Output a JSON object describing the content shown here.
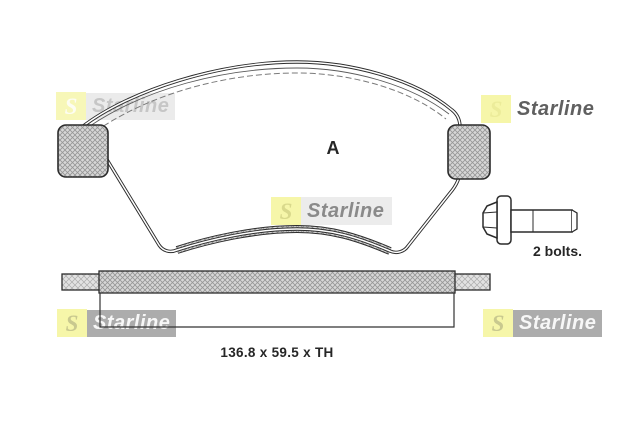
{
  "page": {
    "background": "#ffffff",
    "content_type": "brake-pad-set-technical-illustration"
  },
  "brand": {
    "name": "Starline",
    "initial": "S",
    "accent_yellow": "#f6f6a9",
    "logo_gray": "#acacac"
  },
  "drawing": {
    "view_label": "A",
    "bolt_caption": "2 bolts.",
    "dimension_caption": "136.8 x 59.5 x TH",
    "line_color": "#2b2b2b",
    "views": {
      "front_view": "brake pad front profile with left and right mounting tabs",
      "side_view": "brake pad edge strip with backplate",
      "hardware": "hex flange bolt"
    }
  }
}
